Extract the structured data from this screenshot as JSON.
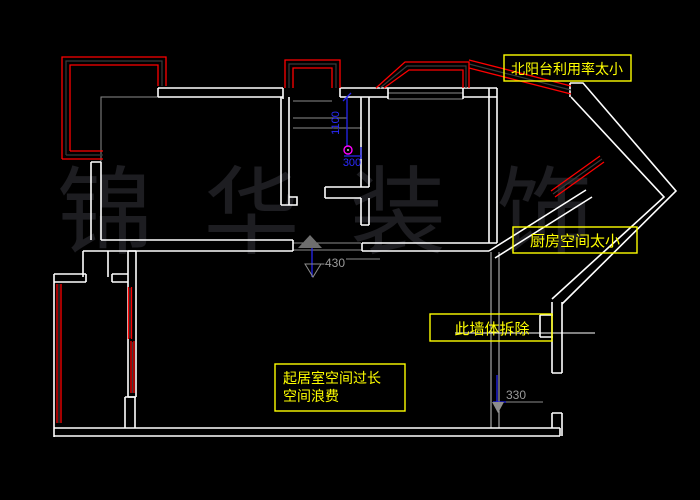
{
  "drawing": {
    "type": "cad-floor-plan",
    "background": "#000000"
  },
  "watermark": {
    "text": "锦 华 装 饰",
    "color": "#1d1d21"
  },
  "labels": {
    "north_balcony": "北阳台利用率太小",
    "kitchen": "厨房空间太小",
    "wall_remove": "此墙体拆除",
    "living_line1": "起居室空间过长",
    "living_line2": "空间浪费"
  },
  "dimensions": {
    "elevation_mid": "-430",
    "elevation_bottom": "330",
    "vertical": "1100",
    "horizontal": "300"
  },
  "colors": {
    "wall": "#ffffff",
    "window": "#ff0000",
    "annotation": "#ffff00",
    "dimension_blue": "#2626ee",
    "construction_gray": "#8c8c8c",
    "marker_magenta": "#ff00ff"
  }
}
